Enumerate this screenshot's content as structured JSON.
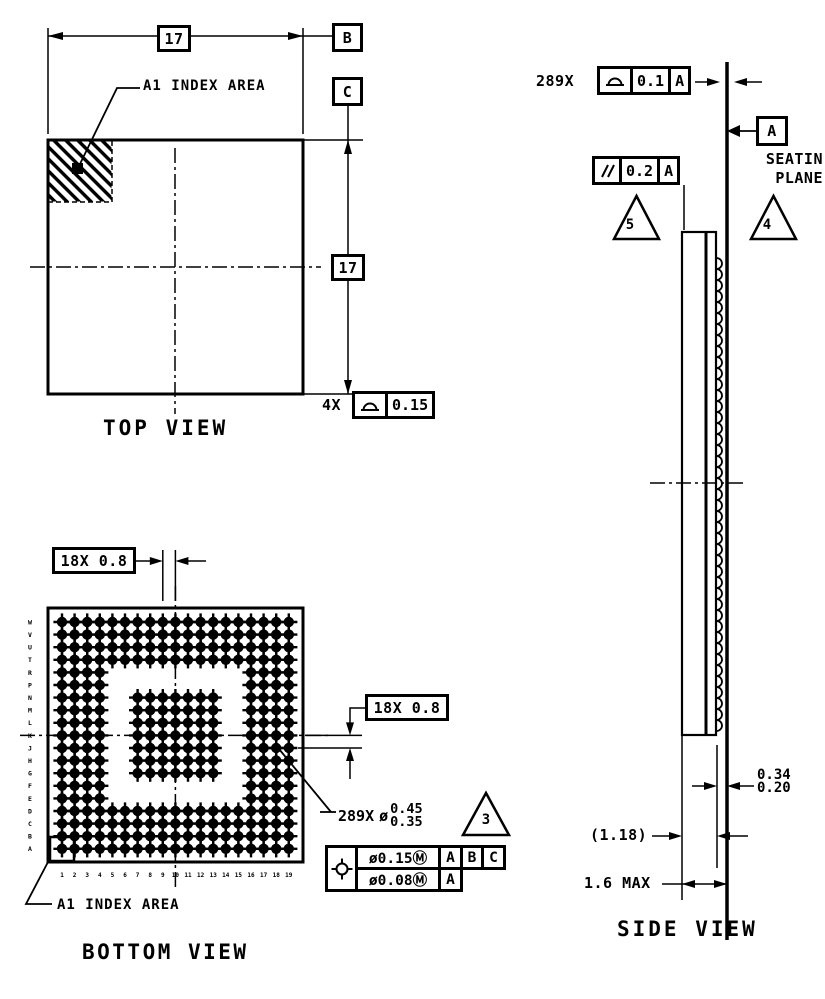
{
  "drawing": {
    "top_view": {
      "title": "TOP VIEW",
      "width_dim": "17",
      "height_dim": "17",
      "datum_b": "B",
      "datum_c": "C",
      "a1_label": "A1 INDEX AREA",
      "flatness_prefix": "4X",
      "flatness_value": "0.15"
    },
    "bottom_view": {
      "title": "BOTTOM VIEW",
      "pitch_dim_top": "18X 0.8",
      "pitch_dim_right": "18X 0.8",
      "a1_label": "A1 INDEX AREA",
      "ball_callout": {
        "count": "289X",
        "dia": "ø",
        "upper": "0.45",
        "lower": "0.35",
        "note": "3"
      },
      "position_frame": {
        "tol1": "ø0.15Ⓜ",
        "datum1a": "A",
        "datum1b": "B",
        "datum1c": "C",
        "tol2": "ø0.08Ⓜ",
        "datum2a": "A"
      },
      "grid": {
        "rows": 19,
        "cols": 19,
        "outer_depth": 4,
        "center_start": 6,
        "center_end": 12,
        "ball_count": 289,
        "row_labels": [
          "W",
          "V",
          "U",
          "T",
          "R",
          "P",
          "N",
          "M",
          "L",
          "K",
          "J",
          "H",
          "G",
          "F",
          "E",
          "D",
          "C",
          "B",
          "A"
        ],
        "col_labels": [
          "1",
          "2",
          "3",
          "4",
          "5",
          "6",
          "7",
          "8",
          "9",
          "10",
          "11",
          "12",
          "13",
          "14",
          "15",
          "16",
          "17",
          "18",
          "19"
        ]
      }
    },
    "side_view": {
      "title": "SIDE VIEW",
      "coplanarity_prefix": "289X",
      "coplanarity_value": "0.1",
      "coplanarity_datum": "A",
      "parallelism_value": "0.2",
      "parallelism_datum": "A",
      "datum_a": "A",
      "seating_line1": "SEATIN",
      "seating_line2": "PLANE",
      "note4": "4",
      "note5": "5",
      "ball_height_max": "0.34",
      "ball_height_min": "0.20",
      "body_height_ref": "(1.18)",
      "total_height": "1.6 MAX"
    }
  }
}
